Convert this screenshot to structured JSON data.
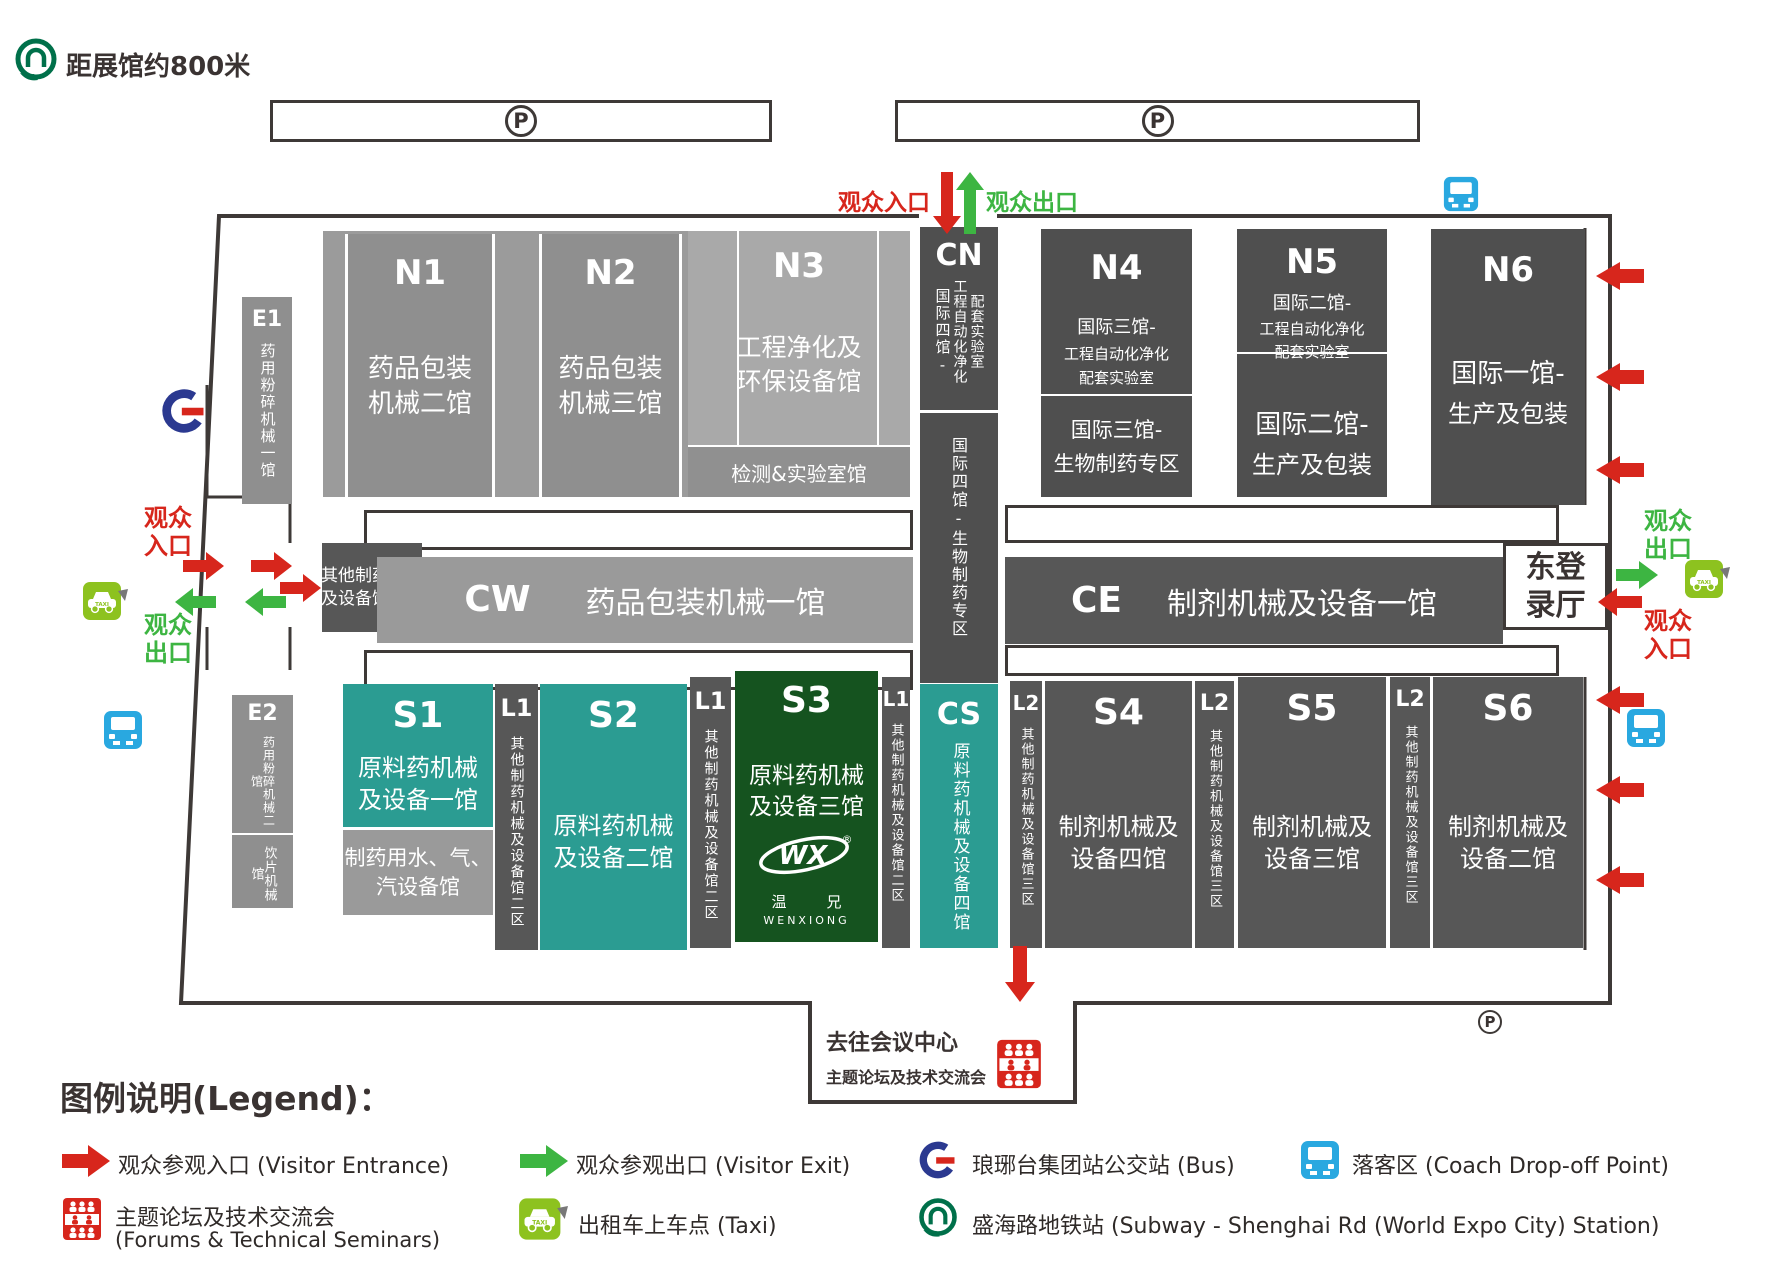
{
  "meta": {
    "parking": "P"
  },
  "header": {
    "subway_distance": "距展馆约800米"
  },
  "entrances": {
    "top_in": "观众入口",
    "top_out": "观众出口",
    "left_in": "观众入口",
    "left_out": "观众出口",
    "right_out": "观众出口",
    "right_in": "观众入口",
    "east_hall": "东登录厅"
  },
  "halls": {
    "e1": {
      "code": "E1",
      "name": "药用粉碎机械一馆"
    },
    "e2": {
      "code": "E2",
      "name": "药用粉碎机械二馆",
      "name2": "饮片机械馆"
    },
    "n1": {
      "code": "N1",
      "name": "药品包装机械二馆"
    },
    "n2": {
      "code": "N2",
      "name": "药品包装机械三馆"
    },
    "n3": {
      "code": "N3",
      "name": "工程净化及环保设备馆",
      "sub": "检测&实验室馆"
    },
    "cn": {
      "code": "CN",
      "v1": "国际四馆-",
      "v2": "工程自动化净化",
      "v3": "配套实验室",
      "lower": "国际四馆-生物制药专区"
    },
    "n4": {
      "code": "N4",
      "u1": "国际三馆-",
      "u2": "工程自动化净化",
      "u3": "配套实验室",
      "l1": "国际三馆-",
      "l2": "生物制药专区"
    },
    "n5": {
      "code": "N5",
      "u1": "国际二馆-",
      "u2": "工程自动化净化",
      "u3": "配套实验室",
      "l1": "国际二馆-",
      "l2": "生产及包装"
    },
    "n6": {
      "code": "N6",
      "l1": "国际一馆-",
      "l2": "生产及包装"
    },
    "zone1": "其他制药机械及设备馆一区",
    "cw": {
      "code": "CW",
      "name": "药品包装机械一馆"
    },
    "ce": {
      "code": "CE",
      "name": "制剂机械及设备一馆"
    },
    "s1": {
      "code": "S1",
      "name": "原料药机械及设备一馆"
    },
    "water": "制药用水、气、汽设备馆",
    "l1": {
      "code": "L1",
      "name": "其他制药机械及设备馆二区"
    },
    "s2": {
      "code": "S2",
      "name": "原料药机械及设备二馆"
    },
    "s3": {
      "code": "S3",
      "name": "原料药机械及设备三馆",
      "logo_wx": "WX",
      "logo_reg": "®",
      "logo_cn": "温兄",
      "logo_en": "WENXIONG"
    },
    "cs": {
      "code": "CS",
      "name": "原料药机械及设备四馆"
    },
    "l2": {
      "code": "L2",
      "name": "其他制药机械及设备馆三区"
    },
    "s4": {
      "code": "S4",
      "name": "制剂机械及设备四馆"
    },
    "s5": {
      "code": "S5",
      "name": "制剂机械及设备三馆"
    },
    "s6": {
      "code": "S6",
      "name": "制剂机械及设备二馆"
    }
  },
  "conference": {
    "title": "去往会议中心",
    "subtitle": "主题论坛及技术交流会"
  },
  "legend": {
    "title": "图例说明(Legend)：",
    "entrance": "观众参观入口 (Visitor Entrance)",
    "exit": "观众参观出口 (Visitor Exit)",
    "bus": "琅琊台集团站公交站 (Bus)",
    "coach": "落客区 (Coach Drop-off Point)",
    "forum_line1": "主题论坛及技术交流会",
    "forum_line2": "(Forums & Technical Seminars)",
    "taxi": "出租车上车点 (Taxi)",
    "subway": "盛海路地铁站 (Subway - Shenghai Rd (World Expo City) Station)"
  },
  "colors": {
    "red": "#d7261c",
    "green": "#3db542",
    "teal": "#2b9c92",
    "dark_green": "#15531f",
    "dark_gray": "#4f4f4f",
    "mid_gray": "#8f8f8f",
    "light_gray": "#a9a9a9",
    "coach_blue": "#29a8e0",
    "taxi_green": "#8dc21f"
  }
}
